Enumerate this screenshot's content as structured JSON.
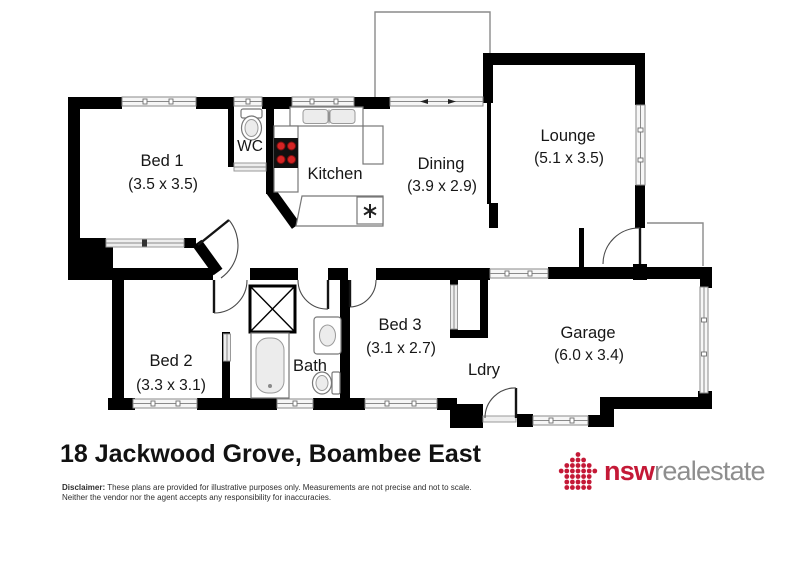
{
  "title": "18 Jackwood Grove, Boambee East",
  "rooms": {
    "bed1": {
      "name": "Bed 1",
      "dims": "(3.5 x 3.5)"
    },
    "wc": {
      "name": "WC"
    },
    "kitchen": {
      "name": "Kitchen"
    },
    "dining": {
      "name": "Dining",
      "dims": "(3.9 x 2.9)"
    },
    "lounge": {
      "name": "Lounge",
      "dims": "(5.1 x 3.5)"
    },
    "bed2": {
      "name": "Bed 2",
      "dims": "(3.3 x 3.1)"
    },
    "bath": {
      "name": "Bath"
    },
    "bed3": {
      "name": "Bed 3",
      "dims": "(3.1 x 2.7)"
    },
    "ldry": {
      "name": "Ldry"
    },
    "garage": {
      "name": "Garage",
      "dims": "(6.0 x 3.4)"
    }
  },
  "disclaimer": {
    "label": "Disclaimer:",
    "line1": "These plans are provided for illustrative purposes only. Measurements are not precise and not to scale.",
    "line2": "Neither the vendor nor the agent accepts any responsibility for inaccuracies."
  },
  "logo": {
    "brand_bold": "nsw",
    "brand_light": "realestate"
  },
  "colors": {
    "wall": "#000000",
    "logo_red": "#c41937",
    "logo_gray": "#8e8e8e"
  }
}
